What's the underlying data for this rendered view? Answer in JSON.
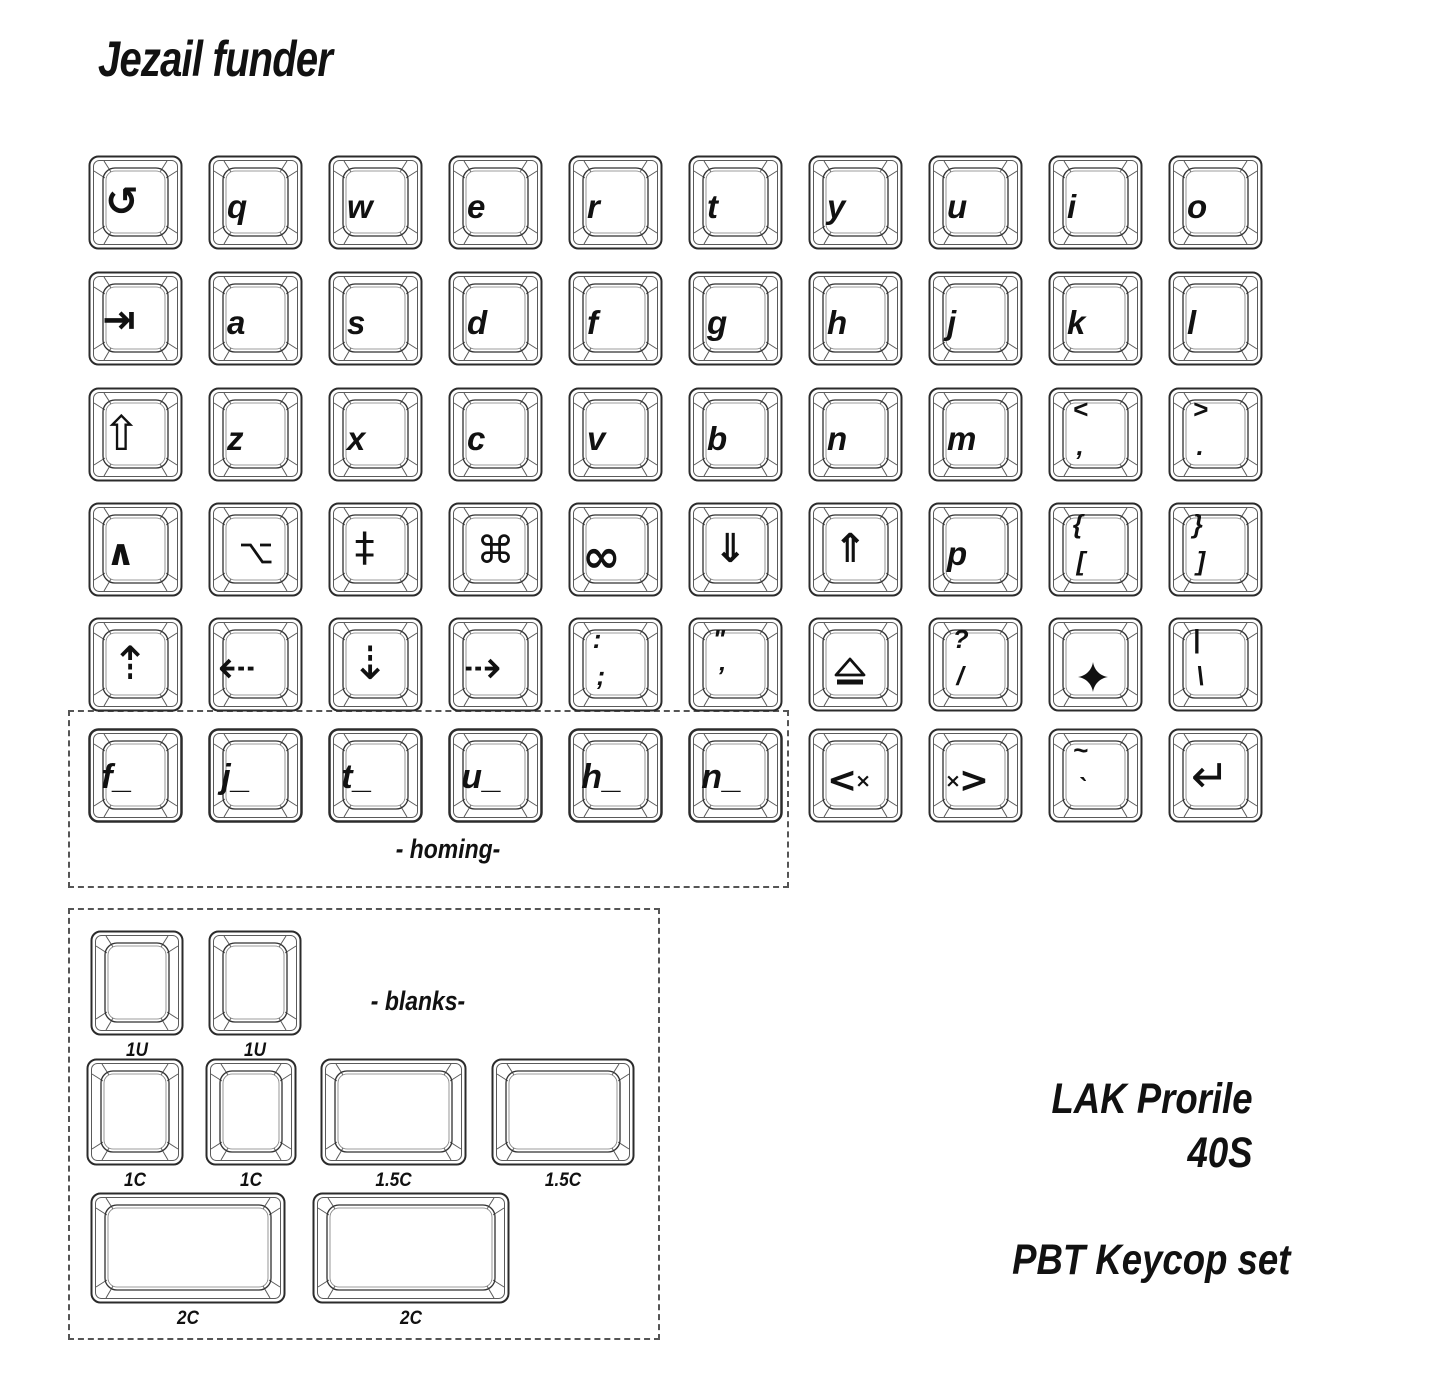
{
  "title": "Jezail funder",
  "labels": {
    "homing": "- homing-",
    "blanks": "- blanks-"
  },
  "footer": {
    "profile": "LAK Prorile",
    "size": "40S",
    "material": "PBT Keycop set"
  },
  "colors": {
    "ink": "#111111",
    "outline": "#2b2b2b",
    "outline_light": "#585858",
    "background": "#ffffff"
  },
  "keyboard": {
    "grid": {
      "x0": 88,
      "pitch": 120,
      "row_y": [
        155,
        271,
        387,
        502,
        617,
        728
      ],
      "key_w": 95,
      "key_h": 95
    },
    "keys": [
      {
        "name": "undo-key",
        "icon": "undo-icon",
        "glyph": "↺",
        "row": 0,
        "col": 0
      },
      {
        "name": "q-key",
        "legend": "q",
        "row": 0,
        "col": 1
      },
      {
        "name": "w-key",
        "legend": "w",
        "row": 0,
        "col": 2
      },
      {
        "name": "e-key",
        "legend": "e",
        "row": 0,
        "col": 3
      },
      {
        "name": "r-key",
        "legend": "r",
        "row": 0,
        "col": 4
      },
      {
        "name": "t-key",
        "legend": "t",
        "row": 0,
        "col": 5
      },
      {
        "name": "y-key",
        "legend": "y",
        "row": 0,
        "col": 6
      },
      {
        "name": "u-key",
        "legend": "u",
        "row": 0,
        "col": 7
      },
      {
        "name": "i-key",
        "legend": "i",
        "row": 0,
        "col": 8
      },
      {
        "name": "o-key",
        "legend": "o",
        "row": 0,
        "col": 9
      },
      {
        "name": "tab-key",
        "icon": "tab-icon",
        "glyph": "⇥",
        "row": 1,
        "col": 0
      },
      {
        "name": "a-key",
        "legend": "a",
        "row": 1,
        "col": 1
      },
      {
        "name": "s-key",
        "legend": "s",
        "row": 1,
        "col": 2
      },
      {
        "name": "d-key",
        "legend": "d",
        "row": 1,
        "col": 3
      },
      {
        "name": "f-key",
        "legend": "f",
        "row": 1,
        "col": 4
      },
      {
        "name": "g-key",
        "legend": "g",
        "row": 1,
        "col": 5
      },
      {
        "name": "h-key",
        "legend": "h",
        "row": 1,
        "col": 6
      },
      {
        "name": "j-key",
        "legend": "j",
        "row": 1,
        "col": 7
      },
      {
        "name": "k-key",
        "legend": "k",
        "row": 1,
        "col": 8
      },
      {
        "name": "l-key",
        "legend": "l",
        "row": 1,
        "col": 9
      },
      {
        "name": "shift-key",
        "icon": "shift-icon",
        "glyph": "⇧",
        "row": 2,
        "col": 0
      },
      {
        "name": "z-key",
        "legend": "z",
        "row": 2,
        "col": 1
      },
      {
        "name": "x-key",
        "legend": "x",
        "row": 2,
        "col": 2
      },
      {
        "name": "c-key",
        "legend": "c",
        "row": 2,
        "col": 3
      },
      {
        "name": "v-key",
        "legend": "v",
        "row": 2,
        "col": 4
      },
      {
        "name": "b-key",
        "legend": "b",
        "row": 2,
        "col": 5
      },
      {
        "name": "n-key",
        "legend": "n",
        "row": 2,
        "col": 6
      },
      {
        "name": "m-key",
        "legend": "m",
        "row": 2,
        "col": 7
      },
      {
        "name": "comma-key",
        "top": "<",
        "bottom": ",",
        "row": 2,
        "col": 8
      },
      {
        "name": "period-key",
        "top": ">",
        "bottom": ".",
        "row": 2,
        "col": 9
      },
      {
        "name": "control-key",
        "icon": "control-icon",
        "glyph": "∧",
        "row": 3,
        "col": 0
      },
      {
        "name": "option-key",
        "icon": "option-icon",
        "row": 3,
        "col": 1
      },
      {
        "name": "double-dagger-key",
        "icon": "double-dagger-icon",
        "glyph": "‡",
        "row": 3,
        "col": 2
      },
      {
        "name": "command-key",
        "icon": "command-icon",
        "glyph": "⌘",
        "row": 3,
        "col": 3
      },
      {
        "name": "infinity-key",
        "icon": "infinity-icon",
        "glyph": "∞",
        "row": 3,
        "col": 4
      },
      {
        "name": "page-down-key",
        "icon": "double-down-arrow-icon",
        "glyph": "⇓",
        "row": 3,
        "col": 5
      },
      {
        "name": "page-up-key",
        "icon": "double-up-arrow-icon",
        "glyph": "⇑",
        "row": 3,
        "col": 6
      },
      {
        "name": "p-key",
        "legend": "p",
        "row": 3,
        "col": 7
      },
      {
        "name": "open-bracket-key",
        "top": "{",
        "bottom": "[",
        "row": 3,
        "col": 8
      },
      {
        "name": "close-bracket-key",
        "top": "}",
        "bottom": "]",
        "row": 3,
        "col": 9
      },
      {
        "name": "up-arrow-key",
        "icon": "dashed-up-arrow-icon",
        "glyph": "⇡",
        "row": 4,
        "col": 0
      },
      {
        "name": "left-arrow-key",
        "icon": "dashed-left-arrow-icon",
        "glyph": "⇠",
        "row": 4,
        "col": 1
      },
      {
        "name": "down-arrow-key",
        "icon": "dashed-down-arrow-icon",
        "glyph": "⇣",
        "row": 4,
        "col": 2
      },
      {
        "name": "right-arrow-key",
        "icon": "dashed-right-arrow-icon",
        "glyph": "⇢",
        "row": 4,
        "col": 3
      },
      {
        "name": "semicolon-key",
        "top": ":",
        "bottom": ";",
        "row": 4,
        "col": 4
      },
      {
        "name": "quote-key",
        "top": "\"",
        "bottom": "’",
        "row": 4,
        "col": 5
      },
      {
        "name": "eject-key",
        "icon": "eject-icon",
        "row": 4,
        "col": 6
      },
      {
        "name": "slash-key",
        "top": "?",
        "bottom": "/",
        "row": 4,
        "col": 7
      },
      {
        "name": "star-key",
        "icon": "star-icon",
        "row": 4,
        "col": 8
      },
      {
        "name": "pipe-key",
        "top": "|",
        "bottom": "\\",
        "row": 4,
        "col": 9
      },
      {
        "name": "homing-f-key",
        "legend": "f_",
        "homing": true,
        "row": 5,
        "col": 0
      },
      {
        "name": "homing-j-key",
        "legend": "j_",
        "homing": true,
        "row": 5,
        "col": 1
      },
      {
        "name": "homing-t-key",
        "legend": "t_",
        "homing": true,
        "row": 5,
        "col": 2
      },
      {
        "name": "homing-u-key",
        "legend": "u_",
        "homing": true,
        "row": 5,
        "col": 3
      },
      {
        "name": "homing-h-key",
        "legend": "h_",
        "homing": true,
        "row": 5,
        "col": 4
      },
      {
        "name": "homing-n-key",
        "legend": "n_",
        "homing": true,
        "row": 5,
        "col": 5
      },
      {
        "name": "backspace-key",
        "icon": "backspace-icon",
        "glyph": "<×",
        "row": 5,
        "col": 6
      },
      {
        "name": "delete-forward-key",
        "icon": "delete-forward-icon",
        "glyph": "×>",
        "row": 5,
        "col": 7
      },
      {
        "name": "tilde-key",
        "top": "~",
        "bottom": "`",
        "row": 5,
        "col": 8
      },
      {
        "name": "return-key",
        "icon": "return-icon",
        "glyph": "↵",
        "row": 5,
        "col": 9
      }
    ]
  },
  "blanks": {
    "items": [
      {
        "name": "blank-1u-left",
        "label": "1U",
        "x": 90,
        "y": 930,
        "w": 94,
        "h": 106
      },
      {
        "name": "blank-1u-right",
        "label": "1U",
        "x": 208,
        "y": 930,
        "w": 94,
        "h": 106
      },
      {
        "name": "blank-1c-left",
        "label": "1C",
        "x": 86,
        "y": 1058,
        "w": 98,
        "h": 108
      },
      {
        "name": "blank-1c-right",
        "label": "1C",
        "x": 205,
        "y": 1058,
        "w": 92,
        "h": 108
      },
      {
        "name": "blank-1-5c-left",
        "label": "1.5C",
        "x": 320,
        "y": 1058,
        "w": 147,
        "h": 108
      },
      {
        "name": "blank-1-5c-right",
        "label": "1.5C",
        "x": 491,
        "y": 1058,
        "w": 144,
        "h": 108
      },
      {
        "name": "blank-2c-left",
        "label": "2C",
        "x": 90,
        "y": 1192,
        "w": 196,
        "h": 112
      },
      {
        "name": "blank-2c-right",
        "label": "2C",
        "x": 312,
        "y": 1192,
        "w": 198,
        "h": 112
      }
    ]
  }
}
